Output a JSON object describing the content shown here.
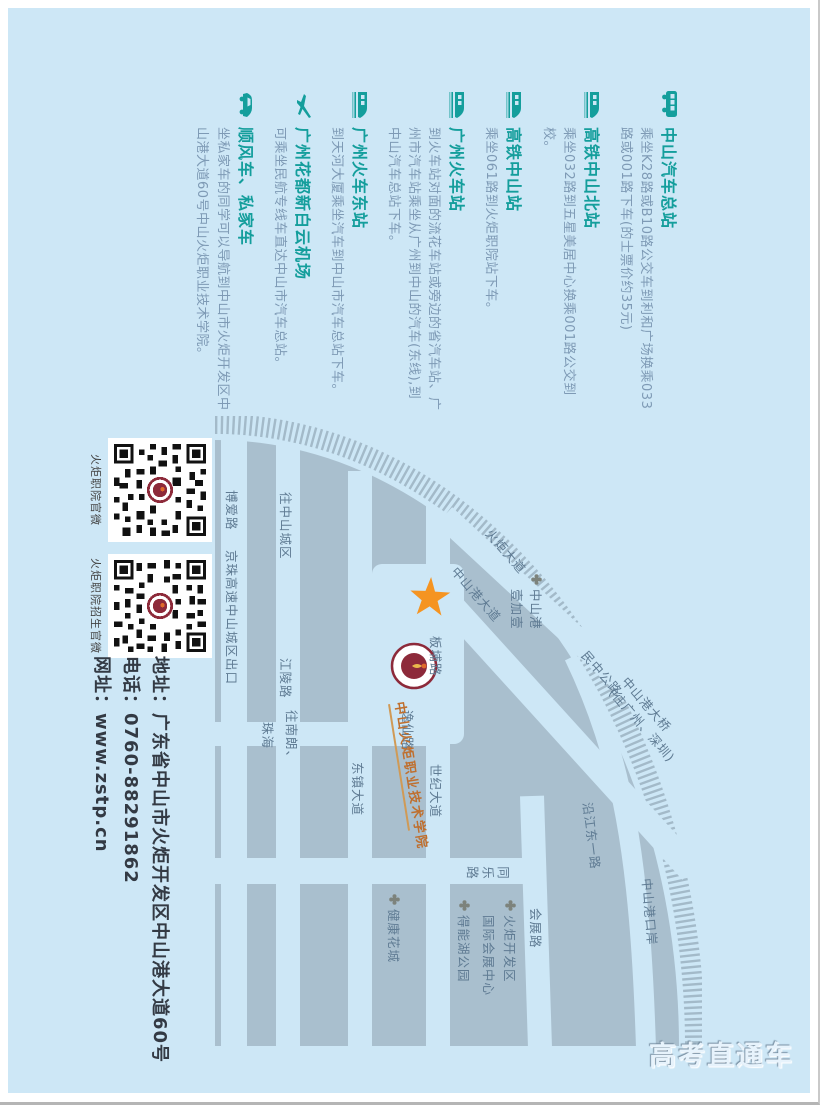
{
  "page": {
    "watermark": "高考直通车"
  },
  "transport": {
    "sections": [
      {
        "icon": "bus-icon",
        "title": "中山汽车总站",
        "desc": "乘坐K28路或B10路公交车到利和广场换乘033路或001路下车(的士票价约35元)"
      },
      {
        "icon": "train-icon",
        "title": "高铁中山北站",
        "desc": "乘坐032路到五星美居中心换乘001路公交到校。"
      },
      {
        "icon": "train-icon",
        "title": "高铁中山站",
        "desc": "乘坐061路到火炬职院站下车。"
      },
      {
        "icon": "train-icon",
        "title": "广州火车站",
        "desc": "到火车站对面的流花车站或旁边的省汽车站、广州市汽车站乘坐从广州到中山的汽车(东线),到中山汽车总站下车。"
      },
      {
        "icon": "train-icon",
        "title": "广州火车东站",
        "desc": "到天河大厦乘坐汽车到中山市汽车总站下车。"
      },
      {
        "icon": "plane-icon",
        "title": "广州花都新白云机场",
        "desc": "可乘坐民航专线车直达中山市汽车总站。"
      },
      {
        "icon": "car-icon",
        "title": "顺风车、私家车",
        "desc": "坐私家车的同学可以导航到中山市火炬开发区中山港大道60号中山火炬职业技术学院。"
      }
    ]
  },
  "map": {
    "labels": {
      "boailu": "博爱路",
      "jingzhu": "京珠高速中山城区出口",
      "wang_zhongshan": "往中山城区",
      "jianglinglu": "江陵路",
      "wang_nanlang1": "往南朗、",
      "wang_nanlang2": "珠海",
      "dongzhen": "东镇大道",
      "shiji": "世纪大道",
      "banbulu": "板埔路",
      "yixianlu": "逸仙路",
      "tonglelu": "同乐路",
      "huizhanlu": "会展路",
      "yanjiang": "沿江东一路",
      "gangkouan": "中山港口岸",
      "zsg_dadao": "中山港大道",
      "huoju_dadao": "火炬大道",
      "minzhong": "民中公路",
      "bridge_line1": "中山港大桥",
      "bridge_line2": "(往广州、深圳)"
    },
    "pois": {
      "yijiayi_line1": "中山港",
      "yijiayi_line2": "壹加壹",
      "exhibition_line1": "火炬开发区",
      "exhibition_line2": "国际会展中心",
      "denenghu": "得能湖公园",
      "jiankang": "健康花城"
    },
    "school": {
      "name": "中山火炬职业技术学院"
    }
  },
  "qr": {
    "items": [
      {
        "label": "火炬职院官微"
      },
      {
        "label": "火炬职院招生官微"
      }
    ]
  },
  "contact": {
    "address": "地址：广东省中山市火炬开发区中山港大道60号",
    "phone": "电话：0760-88291862",
    "web": "网址：www.zstp.cn"
  },
  "colors": {
    "background_blue": "#cde7f6",
    "block_gray": "#a9bfce",
    "heading_teal": "#149e9c",
    "desc_blue_gray": "#7e9ab5",
    "star_orange": "#f59421",
    "logo_maroon": "#8d2a3a",
    "school_name_orange": "#bf6f2e"
  }
}
